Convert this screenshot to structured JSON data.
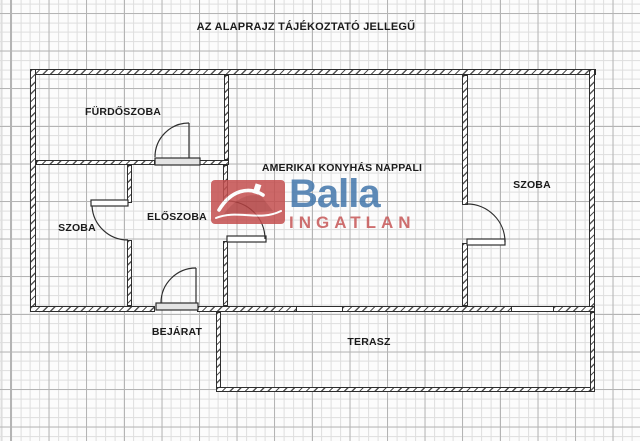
{
  "title": "AZ ALAPRAJZ TÁJÉKOZTATÓ JELLEGŰ",
  "rooms": {
    "bathroom": "FÜRDŐSZOBA",
    "room_left": "SZOBA",
    "hall": "ELŐSZOBA",
    "living": "AMERIKAI KONYHÁS NAPPALI",
    "room_right": "SZOBA",
    "entrance": "BEJÁRAT",
    "terrace": "TERASZ"
  },
  "logo": {
    "name": "Balla",
    "subtitle": "INGATLAN",
    "mark_color": "#c44f4f",
    "name_color": "#4377ac",
    "subtitle_color": "#c65757"
  },
  "colors": {
    "wall": "#2e2e2e",
    "grid_fine": "#dedede",
    "grid_major": "#b4b4b4",
    "background": "#fcfcfc"
  }
}
